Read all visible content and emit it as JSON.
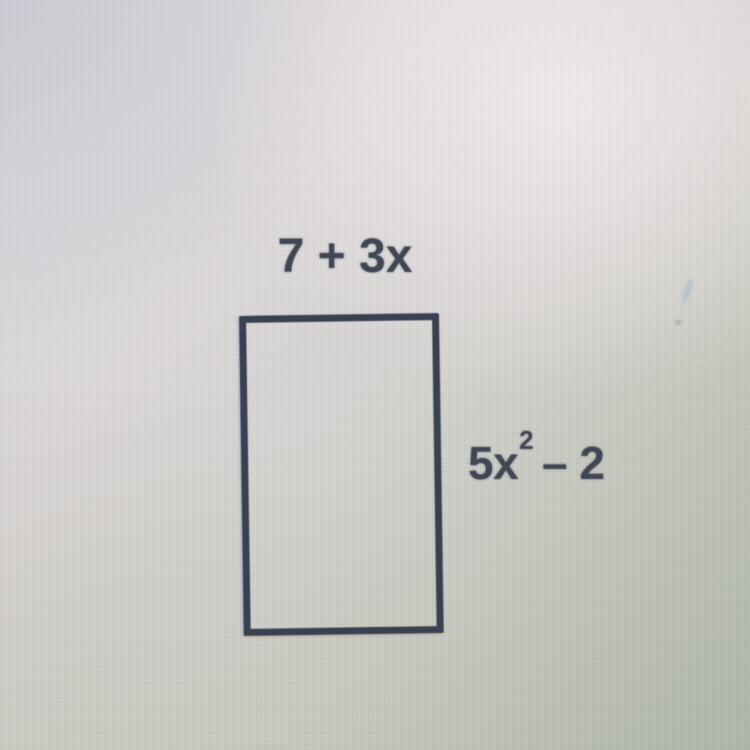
{
  "figure": {
    "shape": "rectangle",
    "top_label": "7 + 3x",
    "side_label": {
      "base": "5x",
      "exponent": "2",
      "tail": "– 2",
      "full": "5x² – 2"
    },
    "colors": {
      "ink": "#414654",
      "rectangle_line": "#39404f",
      "screen_bright": "#e2dddf",
      "screen_dark": "#b0b7ab"
    }
  }
}
